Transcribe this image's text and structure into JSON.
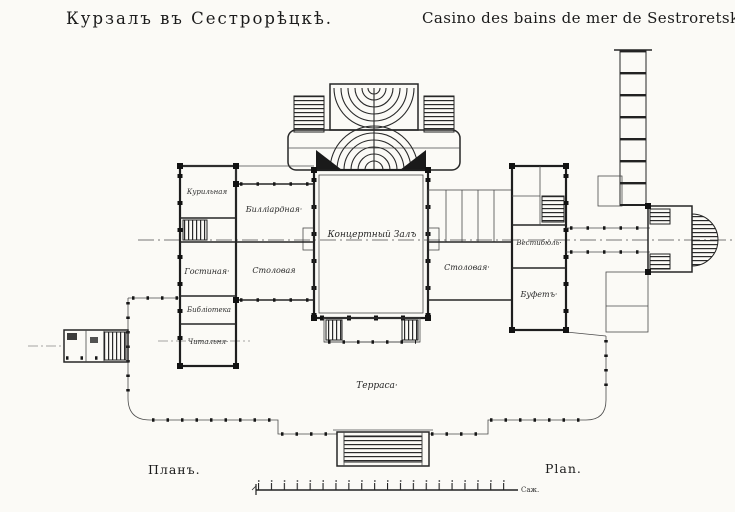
{
  "titles": {
    "left": "Курзалъ въ Сестрорѣцкѣ.",
    "right": "Casino des bains de mer de Sestroretsk."
  },
  "captions": {
    "plan_ru": "Планъ.",
    "plan_fr": "Plan.",
    "scale_unit": "Саж."
  },
  "rooms": {
    "smoking": "Курильная",
    "billiard": "Билліардная·",
    "drawing_room": "Гостиная·",
    "dining_left": "Столовая",
    "library": "Библіотека",
    "reading_room": "Читальня·",
    "concert_hall": "Концертный Залъ",
    "dining_right": "Столовая·",
    "vestibule": "Вестибюль·",
    "buffet": "Буфетъ·",
    "terrace": "Терраса·"
  },
  "colors": {
    "paper": "#fbfaf6",
    "ink": "#1e1e1e"
  }
}
